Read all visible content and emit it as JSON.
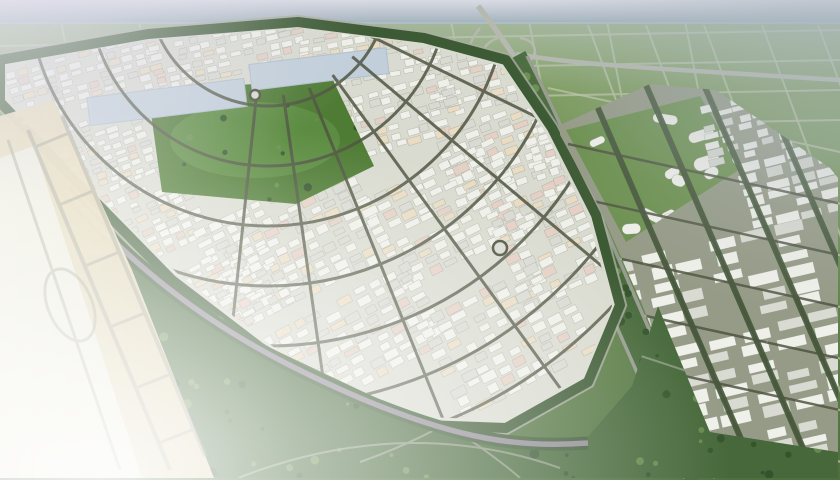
{
  "meta": {
    "description": "Aerial 3D architectural rendering of a fan-shaped master-planned industrial city with dense white warehouse blocks, a central green park with two light-blue water bodies, a rectilinear warehouse district on the right, surrounding agricultural field grids, a highway interchange at the top, a forest green-belt along the south, and a faded beige airport apron with taxiways on the left"
  },
  "palette": {
    "sky1": "#d9dbe4",
    "sky2": "#b9c2cc",
    "sky3": "#9fb2ba",
    "fieldFar": "#8fa96d",
    "fieldMid": "#6d9052",
    "fieldNear": "#4e6f3e",
    "gridLine": "#b8c2a5",
    "highway": "#b6b9b0",
    "arterial": "#989c90",
    "roadMinor": "#4f5542",
    "roadMedian": "#8f8a94",
    "beltGreen": "#3c5a33",
    "forest1": "#46683a",
    "forest2": "#33512b",
    "forest3": "#6b8f50",
    "parkGreen": "#4f7c35",
    "parkLight": "#68994a",
    "lake": "#c2cfda",
    "cityBase": "#d9dbd0",
    "rightBase": "#969b87",
    "organicBase": "#6d9150",
    "bldgWhite": "#f0f0ea",
    "bldgGray": "#d9dad2",
    "bldgCream": "#e9dcc3",
    "bldgPink": "#e4d0c5",
    "bldgEdge": "#8e9284",
    "airportTan": "#e6d9b6",
    "airportPale": "#ecece2",
    "taxiway": "#8b8d82",
    "hazeLav": "#d9d8e6",
    "hazeGray": "#aab6c0"
  },
  "scene": {
    "seed": 42,
    "fields": {
      "top": {
        "vCount": 9,
        "vX0": 60,
        "vSpacing": 78,
        "vSlant": 26,
        "vY0": 16,
        "vY1": 150,
        "hCount": 4,
        "hY0": 38,
        "hSpacing": 30,
        "hDrop": -8
      },
      "right": {
        "colX0s": [
          588,
          646,
          704,
          762,
          818
        ],
        "colY0": 25,
        "colDx": 160,
        "colDy": 430,
        "rowN": 7,
        "rowP0": [
          548,
          88
        ],
        "rowStep": [
          20,
          56
        ],
        "rowDir": [
          292,
          64
        ]
      }
    },
    "fanClusters": [
      {
        "x": 8,
        "y": 52,
        "w": 150,
        "h": 58,
        "a": -16,
        "cw": 13,
        "ch": 8
      },
      {
        "x": 150,
        "y": 28,
        "w": 160,
        "h": 46,
        "a": -13,
        "cw": 13,
        "ch": 8
      },
      {
        "x": 300,
        "y": 26,
        "w": 140,
        "h": 52,
        "a": -11,
        "cw": 14,
        "ch": 8
      },
      {
        "x": 430,
        "y": 46,
        "w": 110,
        "h": 60,
        "a": -14,
        "cw": 14,
        "ch": 9
      },
      {
        "x": 60,
        "y": 112,
        "w": 95,
        "h": 75,
        "a": -20,
        "cw": 13,
        "ch": 8
      },
      {
        "x": 340,
        "y": 84,
        "w": 120,
        "h": 62,
        "a": -16,
        "cw": 15,
        "ch": 9
      },
      {
        "x": 440,
        "y": 110,
        "w": 120,
        "h": 80,
        "a": -20,
        "cw": 16,
        "ch": 10
      },
      {
        "x": 95,
        "y": 170,
        "w": 110,
        "h": 85,
        "a": -24,
        "cw": 13,
        "ch": 8
      },
      {
        "x": 205,
        "y": 190,
        "w": 170,
        "h": 105,
        "a": -26,
        "cw": 16,
        "ch": 10
      },
      {
        "x": 370,
        "y": 165,
        "w": 150,
        "h": 100,
        "a": -26,
        "cw": 17,
        "ch": 10
      },
      {
        "x": 500,
        "y": 185,
        "w": 110,
        "h": 110,
        "a": -24,
        "cw": 16,
        "ch": 10
      },
      {
        "x": 160,
        "y": 255,
        "w": 120,
        "h": 80,
        "a": -27,
        "cw": 14,
        "ch": 9
      },
      {
        "x": 270,
        "y": 295,
        "w": 170,
        "h": 90,
        "a": -28,
        "cw": 17,
        "ch": 10
      },
      {
        "x": 430,
        "y": 280,
        "w": 160,
        "h": 110,
        "a": -27,
        "cw": 17,
        "ch": 11
      },
      {
        "x": 530,
        "y": 120,
        "w": 60,
        "h": 70,
        "a": -18,
        "cw": 14,
        "ch": 9
      }
    ],
    "rightClusters": [
      {
        "x": 700,
        "y": 92,
        "w": 120,
        "h": 62,
        "a": -14,
        "cw": 18,
        "ch": 9
      },
      {
        "x": 740,
        "y": 150,
        "w": 100,
        "h": 70,
        "a": -14,
        "cw": 26,
        "ch": 12
      },
      {
        "x": 612,
        "y": 238,
        "w": 210,
        "h": 88,
        "a": -13,
        "cw": 34,
        "ch": 15
      },
      {
        "x": 640,
        "y": 330,
        "w": 200,
        "h": 100,
        "a": -13,
        "cw": 36,
        "ch": 16
      },
      {
        "x": 680,
        "y": 430,
        "w": 160,
        "h": 46,
        "a": -13,
        "cw": 30,
        "ch": 13
      }
    ],
    "organic": {
      "box": [
        575,
        105,
        160,
        128
      ],
      "count": 16
    },
    "parkTrees": {
      "box": [
        155,
        90,
        210,
        110
      ],
      "count": 12
    },
    "forestTrees": {
      "box": [
        0,
        250,
        840,
        228
      ],
      "count": 150
    },
    "fanRoads": {
      "center": [
        268,
        -14
      ],
      "radii": [
        120,
        180,
        240,
        300,
        360,
        420,
        470
      ],
      "spokesDeg": [
        12,
        26,
        40,
        54,
        68,
        82,
        96
      ],
      "spokeR0": 110,
      "spokeR1": 510
    },
    "arterialTrees": {
      "bezier": [
        [
          512,
          58
        ],
        [
          560,
          150
        ],
        [
          600,
          260
        ],
        [
          700,
          478
        ]
      ],
      "count": 48,
      "halfWidth": 13
    },
    "roundabouts": [
      {
        "cx": 500,
        "cy": 248,
        "r": 7
      },
      {
        "cx": 255,
        "cy": 95,
        "r": 5
      }
    ],
    "lakes": [
      {
        "x": 88,
        "y": 88,
        "w": 158,
        "h": 28,
        "rot": -7
      },
      {
        "x": 250,
        "y": 56,
        "w": 138,
        "h": 26,
        "rot": -7
      }
    ]
  }
}
